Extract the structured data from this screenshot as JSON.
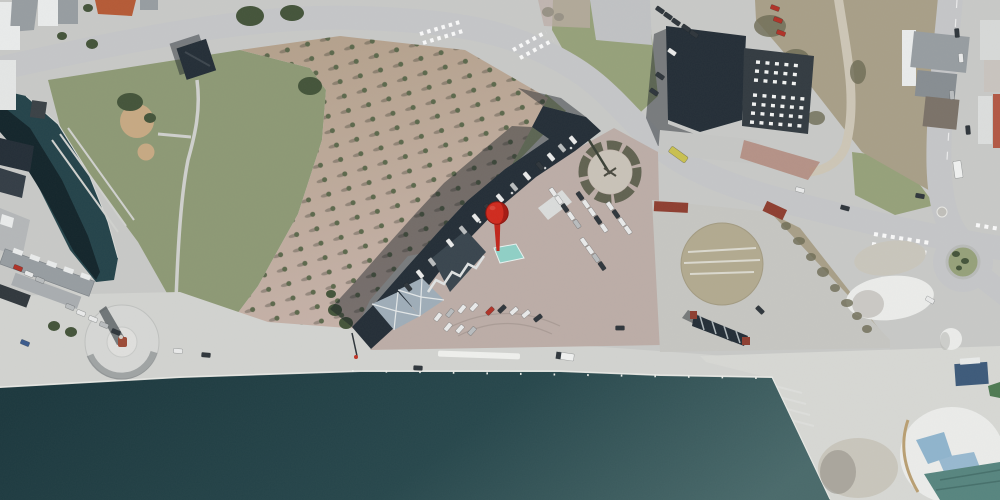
{
  "meta": {
    "type": "aerial-satellite-map",
    "description": "Aerial orthophoto of a harbor waterfront town with a red location pin on a long bent waterfront building"
  },
  "marker": {
    "name": "location-pin",
    "fill": "#d02a1e",
    "shade": "#9e1812",
    "stem": "#c1251b",
    "outline": "#8c150e",
    "highlight": "#e0564a"
  },
  "palette": {
    "base": "#c8c9c7",
    "water_deep": "#1c383e",
    "water_mid": "#27474c",
    "water_light": "#4a6a6b",
    "water_edge": "#e8e9e5",
    "canal": "#24434a",
    "canal_shadow": "#13252b",
    "grass": "#8d9975",
    "grass_bright": "#96a17a",
    "tree": "#44543a",
    "tree_dot": "#5c684c",
    "allee_top": "#b3a08a",
    "allee_bottom": "#c6b2a9",
    "scrub": "#a89f88",
    "scrub_bush": "#6e6c55",
    "dirt": "#c7a983",
    "road": "#c5c6c8",
    "road_minor": "#cbccca",
    "path": "#cfd0cd",
    "promenade": "#d2d3d0",
    "brick": "#bcada7",
    "lot": "#c6c6c2",
    "gravel_circle": "#b2aa90",
    "pier": "#d7d8d4",
    "building_dark": "#242e37",
    "building_mid": "#333b41",
    "building_light": "#39454e",
    "pyramid": "#9fadb8",
    "roof_gray": "#979da1",
    "roof_light": "#aeb6ba",
    "roof_white": "#e9ebeb",
    "roof_red": "#b55a36",
    "red_brown": "#8e3e30",
    "red_wall": "#b25844",
    "sand_white": "#ebecea",
    "sand_gray": "#c9c6bc",
    "sand_shadow": "#a3a099",
    "tarp_blue": "#8fb4cd",
    "tarp_teal": "#57857f",
    "canopy_cyan": "#8fd0c6",
    "monument_fill": "#d6d7d5",
    "monument_inner": "#dfdfdd",
    "statue": "#9c4a36",
    "car_white": "#e9eaea",
    "car_silver": "#b9bcbe",
    "car_dark": "#2f363c",
    "car_red": "#b03227",
    "car_blue": "#3a5a8c",
    "bus_yellow": "#c9c050",
    "truck_white": "#f0f1f0",
    "shadow": "rgba(22,29,36,0.45)",
    "white": "#eef0ee"
  },
  "features": [
    "sea",
    "canal",
    "quay promenade",
    "monument circle",
    "statue",
    "park lawn",
    "tree allee plaza",
    "curved main road",
    "side road",
    "roundabout",
    "crosswalks",
    "bent waterfront building",
    "glass canopy",
    "brick parking plaza",
    "shrub circle",
    "gravel lot",
    "gravel circle",
    "harbor shed",
    "industrial hall with skylights",
    "row houses",
    "town buildings",
    "scrub field",
    "dirt path",
    "sand piles",
    "tarp covered pile",
    "storage tent",
    "floating dock",
    "parked cars",
    "white truck",
    "bus",
    "location pin"
  ]
}
